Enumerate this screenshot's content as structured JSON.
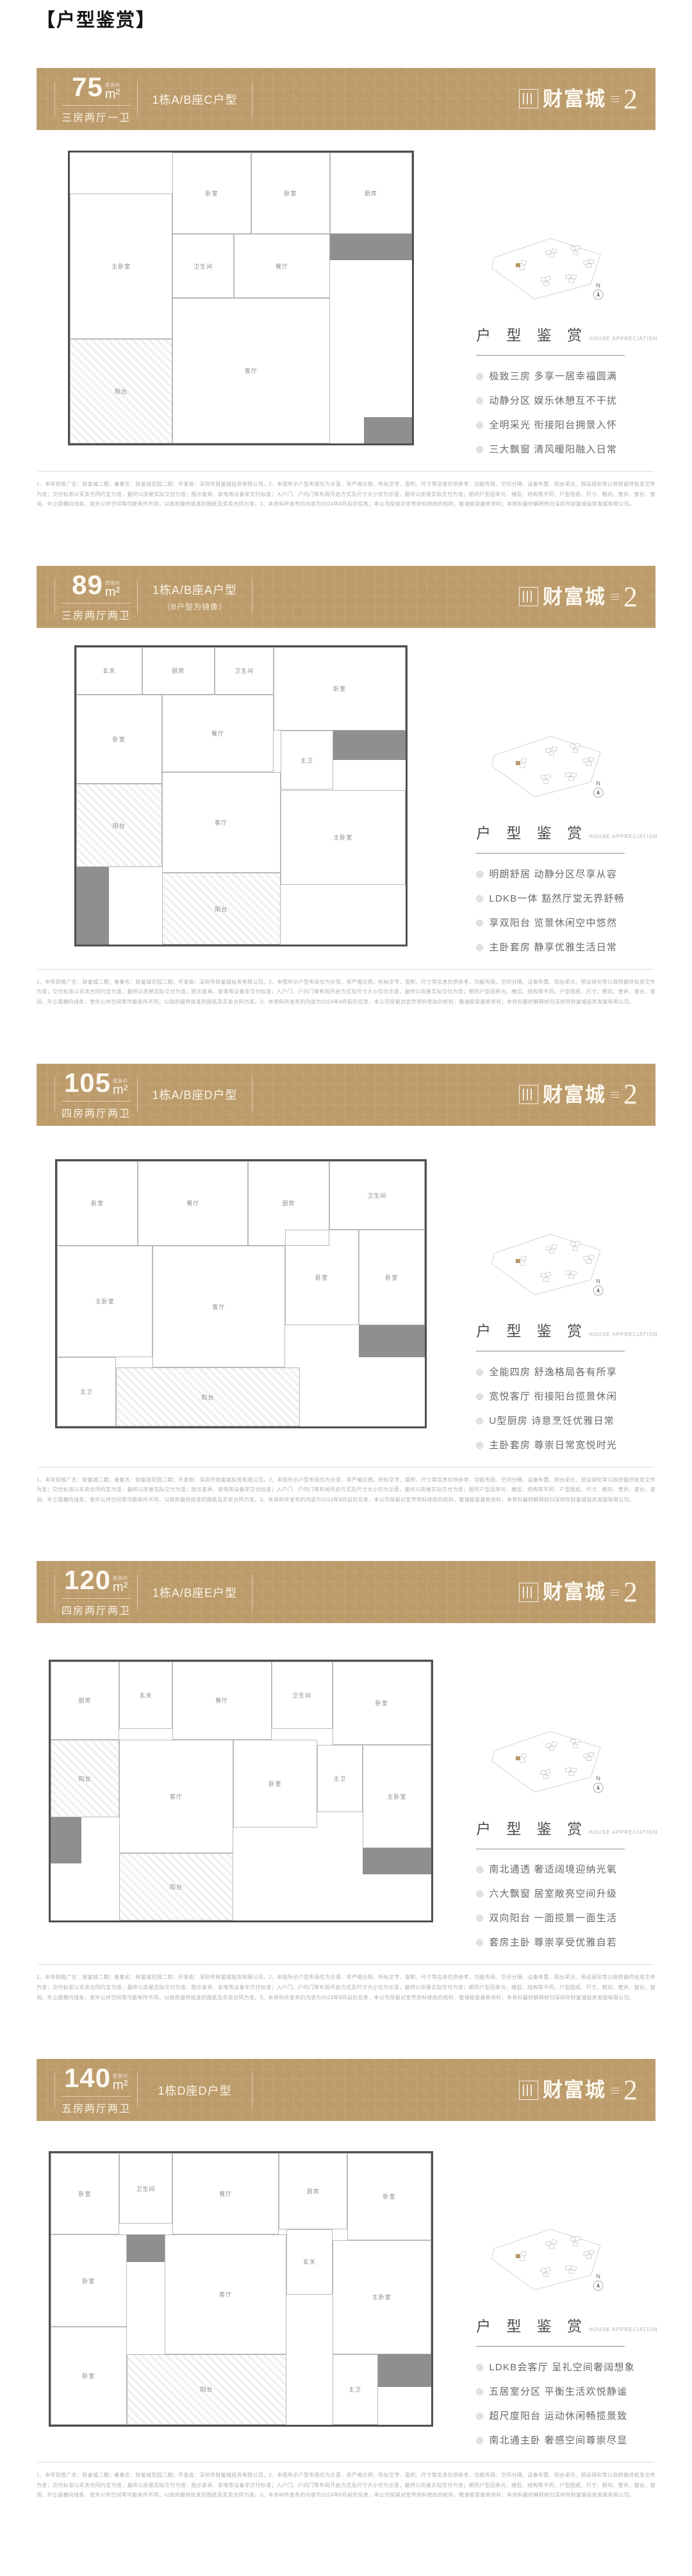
{
  "page": {
    "title": "【户型鉴赏】"
  },
  "brand": {
    "name": "财富城",
    "phase": "2"
  },
  "common": {
    "unit_note": "建面约",
    "unit": "m²",
    "appreciation_title": "户 型 鉴 赏",
    "appreciation_subtitle": "HOUSE APPRECIATION",
    "compass": "N",
    "bullet": "◎",
    "disclaimer": "1、本项目推广名：财富城二期；备案名：财富城花园二期；开发商：深圳市财富城投资有限公司。2、本图所示户型布局仅为示意，非严格比例，所标文字、面积、尺寸等信息仅供参考，功能布局、空间分隔、设备布置、阳台采光、预设绿化等以政府最终批准文件为准；交付标准以买卖合同约定为准，最终以房屋实际交付为准；图示家具、家电等设备非交付标准；入户门、户内门等布局开启方式及尺寸大小仅为示意，最终以房屋实际交付为准；相同户型因单元、楼层、结构等不同，户型图纸、尺寸、朝向、管井、窗台、窗洞、外立面横向线条、室外公共空间等可能有所不同，以政府最终批准的图纸及买卖合同为准。3、本资料所发布的内容为2024年8月前的信息，本公司保留对宣传资料修改的权利，敬请留意最新资料；本资料最终解释权归深圳市财富城投资发展有限公司。"
  },
  "sections": [
    {
      "area": "75",
      "config": "三房两厅一卫",
      "type": "1栋A/B座C户型",
      "mirror": "",
      "features": [
        "极致三房 多享一居幸福圆满",
        "动静分区 娱乐休憩互不干扰",
        "全明采光 衔接阳台拥景入怀",
        "三大飘窗 清风暖阳融入日常"
      ],
      "plan": {
        "rooms": [
          "卧室",
          "卧室",
          "主卧室",
          "卫生间",
          "厨房",
          "餐厅",
          "客厅",
          "阳台"
        ]
      }
    },
    {
      "area": "89",
      "config": "三房两厅两卫",
      "type": "1栋A/B座A户型",
      "mirror": "（B户型为镜像）",
      "features": [
        "明朗舒居 动静分区尽享从容",
        "LDKB一体 豁然厅堂无界舒畅",
        "享双阳台 览景休闲空中悠然",
        "主卧套房 静享优雅生活日常"
      ],
      "plan": {
        "rooms": [
          "玄关",
          "厨房",
          "卫生间",
          "卧室",
          "卧室",
          "餐厅",
          "客厅",
          "主卫",
          "主卧室",
          "阳台",
          "阳台"
        ]
      }
    },
    {
      "area": "105",
      "config": "四房两厅两卫",
      "type": "1栋A/B座D户型",
      "mirror": "",
      "features": [
        "全能四房 舒逸格局各有所享",
        "宽悦客厅 衔接阳台揽景休闲",
        "U型厨房 诗意烹饪优雅日常",
        "主卧套房 尊崇日常宽悦时光"
      ],
      "plan": {
        "rooms": [
          "卧室",
          "餐厅",
          "厨房",
          "卫生间",
          "主卧室",
          "客厅",
          "卧室",
          "卧室",
          "主卫",
          "阳台"
        ]
      }
    },
    {
      "area": "120",
      "config": "四房两厅两卫",
      "type": "1栋A/B座E户型",
      "mirror": "",
      "features": [
        "南北通透 奢适阔境迎纳光氧",
        "六大飘窗 居室敞亮空间升级",
        "双向阳台 一面揽景一面生活",
        "套房主卧 尊崇享受优雅自若"
      ],
      "plan": {
        "rooms": [
          "厨房",
          "玄关",
          "餐厅",
          "卫生间",
          "卧室",
          "客厅",
          "卧室",
          "主卫",
          "主卧室",
          "阳台",
          "阳台"
        ]
      }
    },
    {
      "area": "140",
      "config": "五房两厅两卫",
      "type": "1栋D座D户型",
      "mirror": "",
      "features": [
        "LDKB会客厅 呈礼空间奢阔想象",
        "五居室分区 平衡生活欢悦静谧",
        "超尺度阳台 运动休闲畅揽景致",
        "南北通主卧 奢感空间尊崇尽显"
      ],
      "plan": {
        "rooms": [
          "卧室",
          "卫生间",
          "餐厅",
          "厨房",
          "卧室",
          "卧室",
          "客厅",
          "玄关",
          "主卧室",
          "卧室",
          "主卫",
          "阳台"
        ]
      }
    }
  ]
}
